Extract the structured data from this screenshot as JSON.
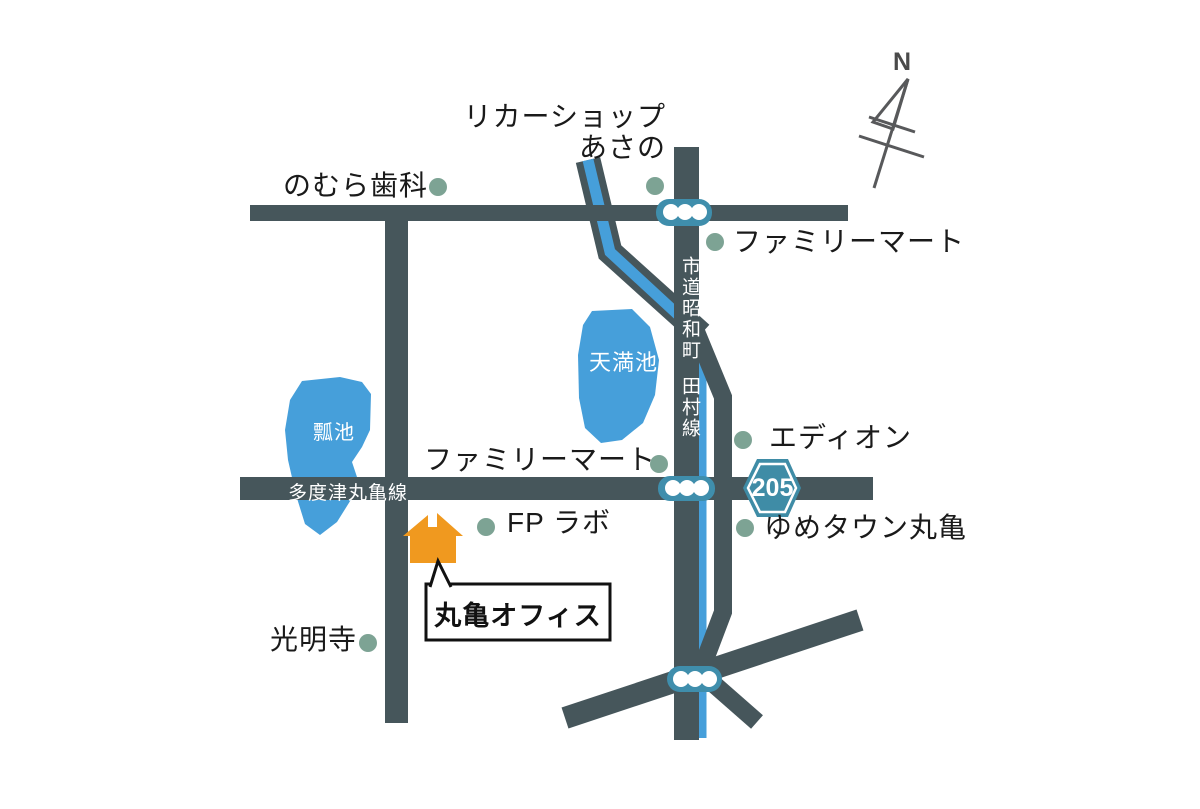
{
  "compass": {
    "north_label": "N"
  },
  "roads": {
    "tadotsu_marugame_line": "多度津丸亀線",
    "shido_showacho": "市道昭和町",
    "tamura_line": "田村線"
  },
  "route_shield": {
    "number": "205"
  },
  "ponds": [
    {
      "name": "瓢池"
    },
    {
      "name": "天満池"
    }
  ],
  "places": [
    {
      "id": "liquor-shop-asano",
      "label_line1": "リカーショップ",
      "label_line2": "あさの"
    },
    {
      "id": "nomura-dental",
      "label": "のむら歯科"
    },
    {
      "id": "familymart-north",
      "label": "ファミリーマート"
    },
    {
      "id": "edion",
      "label": "エディオン"
    },
    {
      "id": "familymart-central",
      "label": "ファミリーマート"
    },
    {
      "id": "yumetown-marugame",
      "label": "ゆめタウン丸亀"
    },
    {
      "id": "fp-lab",
      "label": "FP ラボ"
    },
    {
      "id": "komyoji-temple",
      "label": "光明寺"
    }
  ],
  "office_callout": {
    "label": "丸亀オフィス"
  },
  "colors": {
    "road": "#46565b",
    "water": "#469fda",
    "traffic_light": "#3f8eac",
    "route_shield": "#3f8ca6",
    "place_marker": "#7da394",
    "office_building": "#f0991f",
    "text": "#1a1a1a",
    "road_text": "#ffffff",
    "compass": "#58595b"
  }
}
